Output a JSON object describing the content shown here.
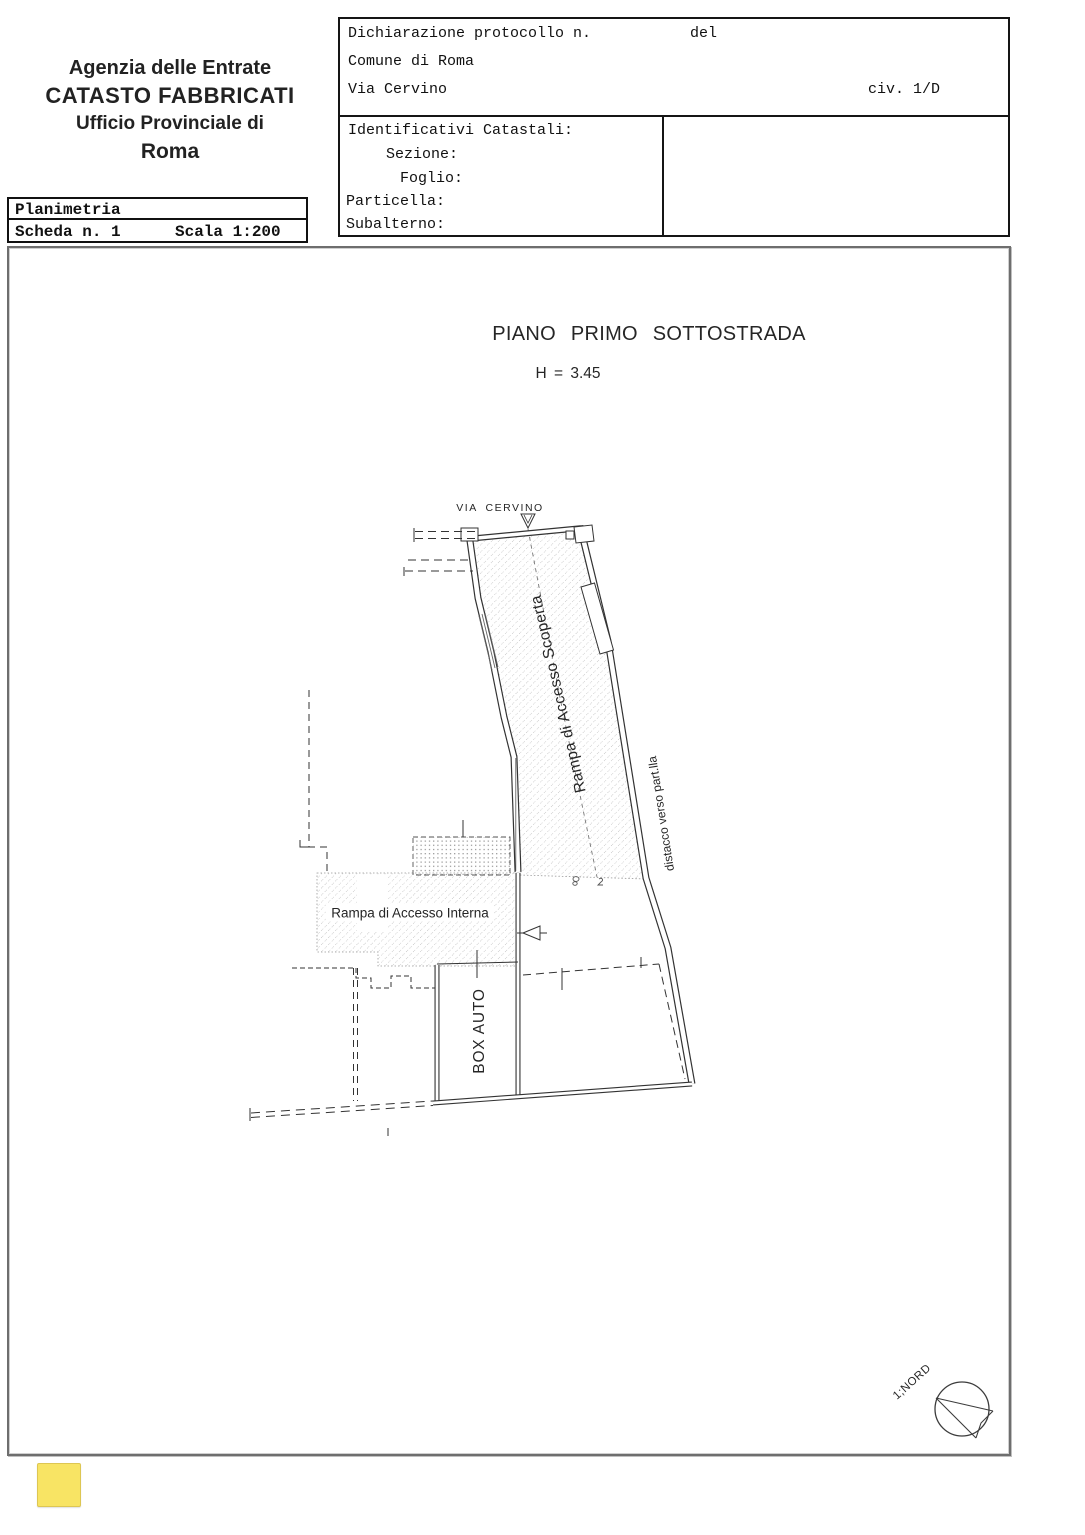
{
  "header": {
    "agency_line1": "Agenzia delle Entrate",
    "agency_line2": "CATASTO FABBRICATI",
    "agency_line3": "Ufficio Provinciale di",
    "agency_line4": "Roma"
  },
  "planimetria_box": {
    "title": "Planimetria",
    "scheda": "Scheda n. 1",
    "scala": "Scala 1:200"
  },
  "protocol_box": {
    "dichiarazione_label": "Dichiarazione protocollo n.",
    "del_label": "del",
    "comune": "Comune di Roma",
    "via": "Via Cervino",
    "civico": "civ. 1/D",
    "identificativi_label": "Identificativi Catastali:",
    "sezione_label": "Sezione:",
    "foglio_label": "Foglio:",
    "particella_label": "Particella:",
    "subalterno_label": "Subalterno:"
  },
  "plan": {
    "title": "PIANO PRIMO SOTTOSTRADA",
    "height_label": "H = 3.45",
    "street_label": "VIA CERVINO",
    "ramp_scoperta_label": "Rampa di Accesso Scoperta",
    "distacco_label": "distacco verso part.lla",
    "ramp_interna_label": "Rampa di Accesso Interna",
    "box_auto_label": "BOX AUTO",
    "north_label": "1;NORD"
  },
  "colors": {
    "highlight_sticker": "#f8e464",
    "drawing_line": "#333333",
    "hatch_gray": "#b0b0b0"
  }
}
